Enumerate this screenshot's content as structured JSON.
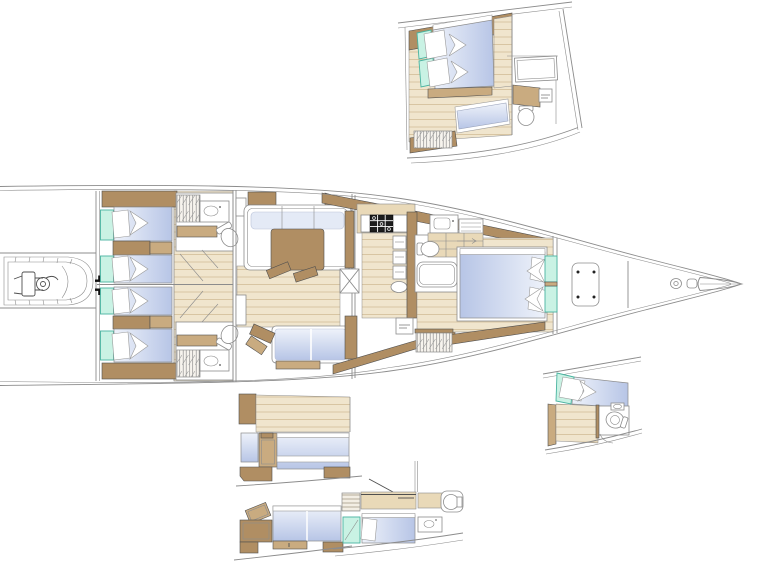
{
  "document": {
    "kind": "sailing-yacht-interior-arrangement-plan",
    "orientation": "bow-right",
    "visible_text": "none (only two tiny illegible equipment labels)"
  },
  "colors": {
    "background": "#ffffff",
    "outline": "#8c8c8c",
    "outline_dark": "#4f4f4f",
    "wood_dark": "#b08e63",
    "wood_mid": "#c9ab80",
    "wood_light": "#e9d9b8",
    "wood_floor": "#f0e5cd",
    "plank_line": "#d2bd97",
    "mint": "#c9f2e4",
    "mint_border": "#49b3a0",
    "bed_blue": "#b7c5e6",
    "bed_blue_light": "#eef2fa",
    "black": "#1c1c1c"
  },
  "main_plan": {
    "areas": [
      "tender-garage-with-rib",
      "aft-cabin-port-twin-berths",
      "aft-cabin-starboard-twin-berths",
      "aft-head-port",
      "aft-head-starboard",
      "saloon-u-sofa-and-table",
      "saloon-starboard-settee",
      "mast-box",
      "galley-with-stove-and-fridges",
      "owner-head-with-shower",
      "owner-cabin-double-bed",
      "hanging-lockers",
      "forepeak-sail-locker",
      "deck-hatch",
      "anchor-windlass-and-bow-fitting"
    ]
  },
  "insets": [
    {
      "id": "owner-cabin-variant",
      "position": "top-right",
      "features": [
        "double-bed",
        "sofa",
        "hanging-locker",
        "shower",
        "toilet",
        "vanity"
      ]
    },
    {
      "id": "forward-cabin-detail",
      "position": "mid-right",
      "features": [
        "berth-with-pillow",
        "wood-floor",
        "toilet",
        "sink"
      ]
    },
    {
      "id": "cabin-variant-upper",
      "position": "bottom-left-upper",
      "features": [
        "athwart-double-berth",
        "wardrobe",
        "side-panel"
      ]
    },
    {
      "id": "cabin-variant-lower",
      "position": "bottom-left-lower",
      "features": [
        "double-berth",
        "desk",
        "cabinet"
      ]
    },
    {
      "id": "crew-cabin-variant",
      "position": "bottom-center",
      "features": [
        "single-berth",
        "louvered-locker",
        "shower-tray",
        "sink",
        "toilet"
      ]
    }
  ]
}
